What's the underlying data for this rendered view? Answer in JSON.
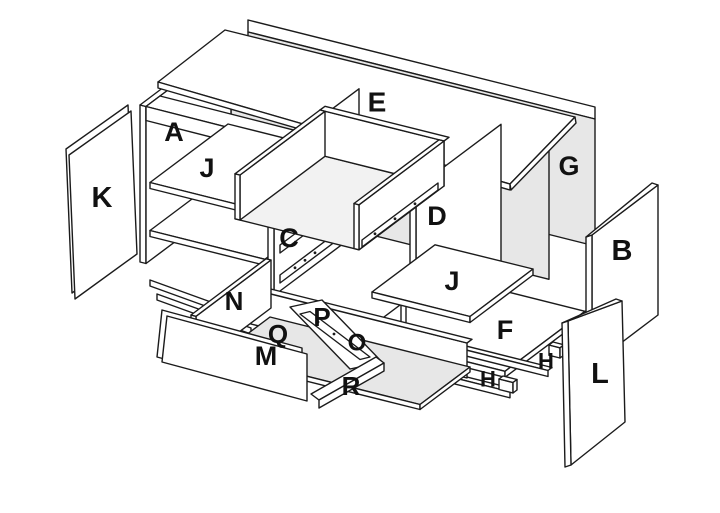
{
  "diagram": {
    "title": "Exploded cabinet assembly diagram",
    "type": "exploded-view",
    "colors": {
      "line": "#1b1b1b",
      "panel": "#ffffff",
      "shade": "#e7e7e7",
      "shade_light": "#f2f2f2",
      "label": "#111111",
      "background": "#ffffff"
    },
    "labels": [
      {
        "letter": "E",
        "x": 377,
        "y": 102,
        "size": 28,
        "part": "top-panel"
      },
      {
        "letter": "A",
        "x": 174,
        "y": 132,
        "size": 27,
        "part": "left-side-panel"
      },
      {
        "letter": "J",
        "x": 207,
        "y": 168,
        "size": 27,
        "part": "left-shelf"
      },
      {
        "letter": "K",
        "x": 102,
        "y": 198,
        "size": 29,
        "part": "left-door"
      },
      {
        "letter": "G",
        "x": 569,
        "y": 166,
        "size": 27,
        "part": "back-panel"
      },
      {
        "letter": "D",
        "x": 437,
        "y": 216,
        "size": 27,
        "part": "right-partition"
      },
      {
        "letter": "C",
        "x": 289,
        "y": 238,
        "size": 27,
        "part": "drawer-slide-rails"
      },
      {
        "letter": "B",
        "x": 622,
        "y": 251,
        "size": 29,
        "part": "right-side-panel"
      },
      {
        "letter": "J",
        "x": 452,
        "y": 281,
        "size": 27,
        "part": "right-shelf"
      },
      {
        "letter": "N",
        "x": 234,
        "y": 301,
        "size": 26,
        "part": "drawer-side-left"
      },
      {
        "letter": "P",
        "x": 322,
        "y": 317,
        "size": 26,
        "part": "drawer-back"
      },
      {
        "letter": "Q",
        "x": 278,
        "y": 334,
        "size": 26,
        "part": "drawer-bottom"
      },
      {
        "letter": "M",
        "x": 266,
        "y": 356,
        "size": 27,
        "part": "drawer-front"
      },
      {
        "letter": "O",
        "x": 357,
        "y": 343,
        "size": 24,
        "part": "drawer-runner"
      },
      {
        "letter": "F",
        "x": 505,
        "y": 330,
        "size": 27,
        "part": "bottom-panel"
      },
      {
        "letter": "H",
        "x": 546,
        "y": 361,
        "size": 22,
        "part": "connector-block-back"
      },
      {
        "letter": "H",
        "x": 488,
        "y": 379,
        "size": 22,
        "part": "connector-block-front"
      },
      {
        "letter": "L",
        "x": 600,
        "y": 374,
        "size": 29,
        "part": "right-door"
      },
      {
        "letter": "R",
        "x": 351,
        "y": 386,
        "size": 26,
        "part": "rail-strip"
      }
    ]
  }
}
